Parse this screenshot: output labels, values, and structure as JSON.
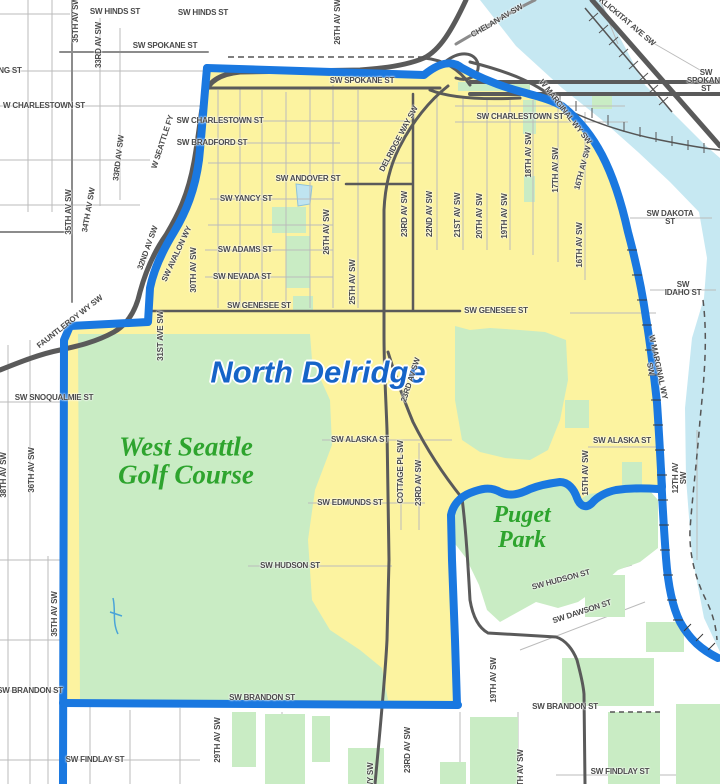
{
  "map": {
    "title": "North Delridge",
    "neighborhood": "North Delridge",
    "parks": [
      "West Seattle Golf Course",
      "Puget Park"
    ]
  },
  "colors": {
    "neighborhood_yellow": "#FCF3A0",
    "park_green": "#C9ECC4",
    "water_blue": "#C6E8F2",
    "boundary_blue": "#1A78E0",
    "place_text_blue": "#1664C8",
    "place_text_green": "#2EA42E",
    "street_label_gray": "#4A4A4A",
    "road_dark": "#5A5A5A",
    "road_medium": "#8C8C8C",
    "road_minor": "#BBBBBB",
    "rail_gray": "#555555",
    "pond_blue": "#BFE4F0"
  },
  "labels": [
    {
      "text": "SW HINDS ST",
      "x": 115,
      "y": 12,
      "r": 0,
      "cls": "street"
    },
    {
      "text": "SW HINDS ST",
      "x": 203,
      "y": 13,
      "r": 0,
      "cls": "street"
    },
    {
      "text": "35TH AV SW",
      "x": 76,
      "y": 20,
      "r": -90,
      "cls": "street"
    },
    {
      "text": "26TH AV SW",
      "x": 338,
      "y": 22,
      "r": -90,
      "cls": "street"
    },
    {
      "text": "SW SPOKANE ST",
      "x": 165,
      "y": 46,
      "r": 0,
      "cls": "street"
    },
    {
      "text": "SW SPOKANE ST",
      "x": 362,
      "y": 81,
      "r": 0,
      "cls": "street"
    },
    {
      "text": "SW SPOKANE ST",
      "x": 706,
      "y": 81,
      "r": 0,
      "cls": "street"
    },
    {
      "text": "CHELAN AV SW",
      "x": 497,
      "y": 21,
      "r": -30,
      "cls": "street"
    },
    {
      "text": "KLICKITAT AVE SW",
      "x": 627,
      "y": 22,
      "r": 40,
      "cls": "street"
    },
    {
      "text": "NG ST",
      "x": 10,
      "y": 71,
      "r": 0,
      "cls": "street"
    },
    {
      "text": "W CHARLESTOWN ST",
      "x": 44,
      "y": 106,
      "r": 0,
      "cls": "street"
    },
    {
      "text": "33RD AV SW",
      "x": 99,
      "y": 45,
      "r": -90,
      "cls": "street"
    },
    {
      "text": "SW CHARLESTOWN ST",
      "x": 220,
      "y": 121,
      "r": 0,
      "cls": "street"
    },
    {
      "text": "SW BRADFORD ST",
      "x": 212,
      "y": 143,
      "r": 0,
      "cls": "street"
    },
    {
      "text": "33RD AV SW",
      "x": 119,
      "y": 158,
      "r": -83,
      "cls": "street"
    },
    {
      "text": "34TH AV SW",
      "x": 89,
      "y": 210,
      "r": -80,
      "cls": "street"
    },
    {
      "text": "35TH AV SW",
      "x": 69,
      "y": 212,
      "r": -90,
      "cls": "street"
    },
    {
      "text": "32ND AV SW",
      "x": 148,
      "y": 248,
      "r": -70,
      "cls": "street"
    },
    {
      "text": "SW AVALON WY",
      "x": 177,
      "y": 254,
      "r": -65,
      "cls": "street"
    },
    {
      "text": "30TH AV SW",
      "x": 194,
      "y": 270,
      "r": -90,
      "cls": "street"
    },
    {
      "text": "FAUNTLEROY WY SW",
      "x": 70,
      "y": 322,
      "r": -38,
      "cls": "street"
    },
    {
      "text": "W SEATTLE FY",
      "x": 163,
      "y": 142,
      "r": -72,
      "cls": "street"
    },
    {
      "text": "SW ANDOVER ST",
      "x": 308,
      "y": 179,
      "r": 0,
      "cls": "street"
    },
    {
      "text": "SW YANCY ST",
      "x": 246,
      "y": 199,
      "r": 0,
      "cls": "street"
    },
    {
      "text": "26TH AV SW",
      "x": 327,
      "y": 232,
      "r": -90,
      "cls": "street"
    },
    {
      "text": "SW ADAMS ST",
      "x": 245,
      "y": 250,
      "r": 0,
      "cls": "street"
    },
    {
      "text": "SW NEVADA ST",
      "x": 242,
      "y": 277,
      "r": 0,
      "cls": "street"
    },
    {
      "text": "SW GENESEE ST",
      "x": 259,
      "y": 306,
      "r": 0,
      "cls": "street"
    },
    {
      "text": "25TH AV SW",
      "x": 353,
      "y": 282,
      "r": -90,
      "cls": "street"
    },
    {
      "text": "DELRIDGE WAY SW",
      "x": 399,
      "y": 139,
      "r": -62,
      "cls": "street"
    },
    {
      "text": "23RD AV SW",
      "x": 405,
      "y": 214,
      "r": -90,
      "cls": "street"
    },
    {
      "text": "22ND AV SW",
      "x": 430,
      "y": 214,
      "r": -90,
      "cls": "street"
    },
    {
      "text": "21ST AV SW",
      "x": 458,
      "y": 215,
      "r": -90,
      "cls": "street"
    },
    {
      "text": "20TH AV SW",
      "x": 480,
      "y": 216,
      "r": -90,
      "cls": "street"
    },
    {
      "text": "19TH AV SW",
      "x": 505,
      "y": 216,
      "r": -90,
      "cls": "street"
    },
    {
      "text": "18TH AV SW",
      "x": 529,
      "y": 155,
      "r": -90,
      "cls": "street"
    },
    {
      "text": "17TH AV SW",
      "x": 556,
      "y": 170,
      "r": -90,
      "cls": "street"
    },
    {
      "text": "16TH AV SW",
      "x": 580,
      "y": 245,
      "r": -90,
      "cls": "street"
    },
    {
      "text": "16TH AV SW",
      "x": 583,
      "y": 168,
      "r": -75,
      "cls": "street"
    },
    {
      "text": "W MARGINAL WY SW",
      "x": 565,
      "y": 112,
      "r": 52,
      "cls": "street"
    },
    {
      "text": "SW CHARLESTOWN ST",
      "x": 520,
      "y": 117,
      "r": 0,
      "cls": "street"
    },
    {
      "text": "SW DAKOTA ST",
      "x": 670,
      "y": 218,
      "r": 0,
      "cls": "street"
    },
    {
      "text": "SW IDAHO ST",
      "x": 683,
      "y": 289,
      "r": 0,
      "cls": "street"
    },
    {
      "text": "SW GENESEE ST",
      "x": 496,
      "y": 311,
      "r": 0,
      "cls": "street"
    },
    {
      "text": "31ST AVE SW",
      "x": 161,
      "y": 336,
      "r": -90,
      "cls": "street"
    },
    {
      "text": "North Delridge",
      "x": 318,
      "y": 372,
      "r": 0,
      "cls": "place-blue"
    },
    {
      "text": "West Seattle\nGolf Course",
      "x": 186,
      "y": 461,
      "r": 0,
      "cls": "place-green"
    },
    {
      "text": "SW SNOQUALMIE ST",
      "x": 54,
      "y": 398,
      "r": 0,
      "cls": "street"
    },
    {
      "text": "36TH AV SW",
      "x": 32,
      "y": 470,
      "r": -90,
      "cls": "street"
    },
    {
      "text": "38TH AV SW",
      "x": 4,
      "y": 475,
      "r": -90,
      "cls": "street"
    },
    {
      "text": "SW ALASKA ST",
      "x": 360,
      "y": 440,
      "r": 0,
      "cls": "street"
    },
    {
      "text": "23RD AV SW",
      "x": 411,
      "y": 380,
      "r": -72,
      "cls": "street"
    },
    {
      "text": "COTTAGE PL SW",
      "x": 401,
      "y": 472,
      "r": -90,
      "cls": "street"
    },
    {
      "text": "23RD AV SW",
      "x": 419,
      "y": 483,
      "r": -90,
      "cls": "street"
    },
    {
      "text": "SW EDMUNDS ST",
      "x": 350,
      "y": 503,
      "r": 0,
      "cls": "street"
    },
    {
      "text": "SW HUDSON ST",
      "x": 290,
      "y": 566,
      "r": 0,
      "cls": "street"
    },
    {
      "text": "Puget\nPark",
      "x": 522,
      "y": 528,
      "r": 0,
      "cls": "place-green small"
    },
    {
      "text": "W MARGINAL WY SW",
      "x": 654,
      "y": 368,
      "r": 78,
      "cls": "street"
    },
    {
      "text": "15TH AV SW",
      "x": 586,
      "y": 473,
      "r": -90,
      "cls": "street"
    },
    {
      "text": "12TH AV SW",
      "x": 680,
      "y": 478,
      "r": -90,
      "cls": "street"
    },
    {
      "text": "SW ALASKA ST",
      "x": 622,
      "y": 441,
      "r": 0,
      "cls": "street"
    },
    {
      "text": "SW HUDSON ST",
      "x": 561,
      "y": 580,
      "r": -15,
      "cls": "street"
    },
    {
      "text": "SW DAWSON ST",
      "x": 582,
      "y": 612,
      "r": -18,
      "cls": "street"
    },
    {
      "text": "35TH AV SW",
      "x": 55,
      "y": 614,
      "r": -90,
      "cls": "street"
    },
    {
      "text": "SW BRANDON ST",
      "x": 30,
      "y": 691,
      "r": 0,
      "cls": "street"
    },
    {
      "text": "SW BRANDON ST",
      "x": 262,
      "y": 698,
      "r": 0,
      "cls": "street"
    },
    {
      "text": "SW BRANDON ST",
      "x": 565,
      "y": 707,
      "r": 0,
      "cls": "street"
    },
    {
      "text": "29TH AV SW",
      "x": 218,
      "y": 740,
      "r": -90,
      "cls": "street"
    },
    {
      "text": "19TH AV SW",
      "x": 494,
      "y": 680,
      "r": -90,
      "cls": "street"
    },
    {
      "text": "23RD AV SW",
      "x": 408,
      "y": 750,
      "r": -90,
      "cls": "street"
    },
    {
      "text": "SW FINDLAY ST",
      "x": 95,
      "y": 760,
      "r": 0,
      "cls": "street"
    },
    {
      "text": "SW FINDLAY ST",
      "x": 620,
      "y": 772,
      "r": 0,
      "cls": "street"
    },
    {
      "text": "18TH AV SW",
      "x": 521,
      "y": 772,
      "r": -90,
      "cls": "street"
    },
    {
      "text": "WY SW",
      "x": 371,
      "y": 776,
      "r": -90,
      "cls": "street"
    }
  ]
}
